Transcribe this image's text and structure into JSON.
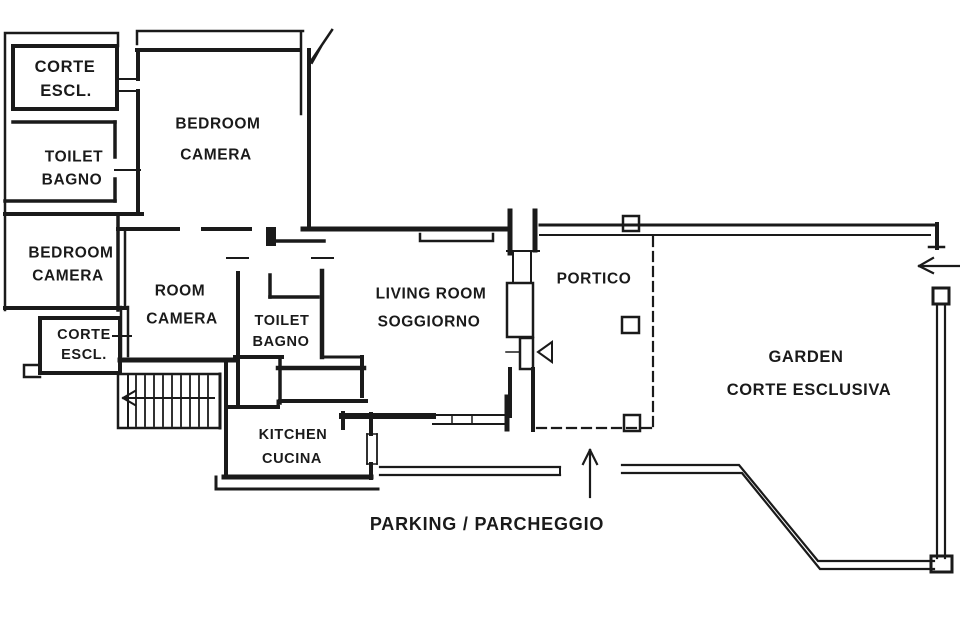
{
  "plan_title": "Apartment floor plan",
  "colors": {
    "ink": "#1a1a1a",
    "background": "#ffffff"
  },
  "rooms": {
    "corte_escl_top": {
      "line1": "CORTE",
      "line2": "ESCL."
    },
    "toilet_top": {
      "line1": "TOILET",
      "line2": "BAGNO"
    },
    "bedroom_top": {
      "line1": "BEDROOM",
      "line2": "CAMERA"
    },
    "bedroom_left": {
      "line1": "BEDROOM",
      "line2": "CAMERA"
    },
    "room_center": {
      "line1": "ROOM",
      "line2": "CAMERA"
    },
    "corte_escl_left": {
      "line1": "CORTE",
      "line2": "ESCL."
    },
    "toilet_center": {
      "line1": "TOILET",
      "line2": "BAGNO"
    },
    "living_room": {
      "line1": "LIVING ROOM",
      "line2": "SOGGIORNO"
    },
    "portico": {
      "line1": "PORTICO"
    },
    "kitchen": {
      "line1": "KITCHEN",
      "line2": "CUCINA"
    },
    "garden": {
      "line1": "GARDEN",
      "line2": "CORTE ESCLUSIVA"
    },
    "parking": {
      "line1": "PARKING / PARCHEGGIO"
    }
  }
}
